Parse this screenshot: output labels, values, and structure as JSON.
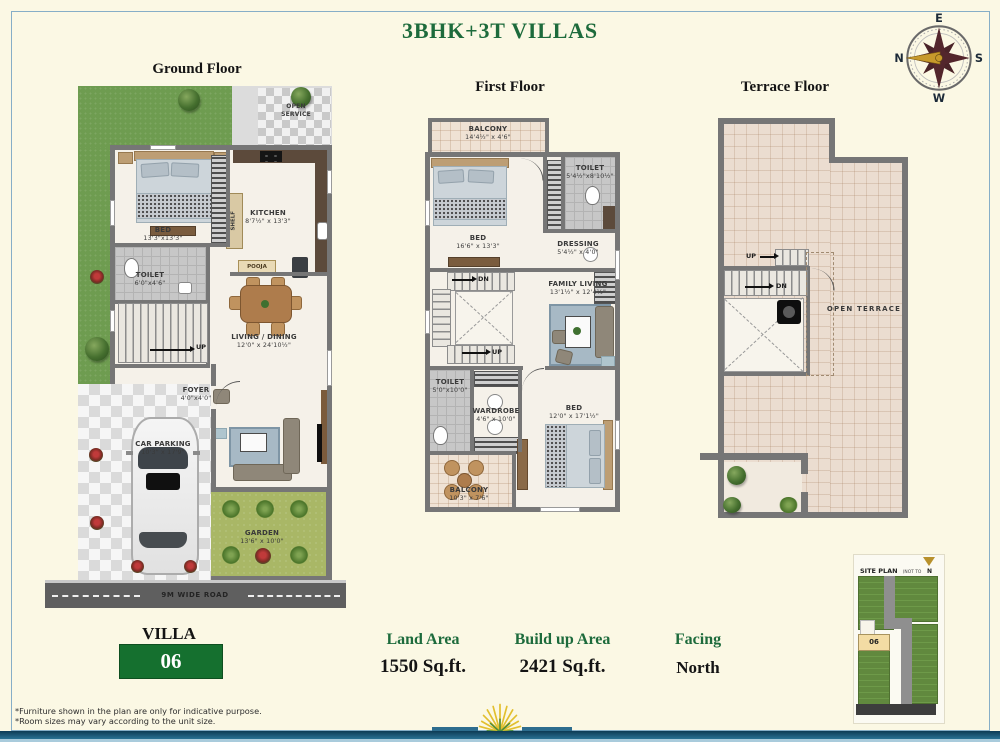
{
  "title": "3BHK+3T VILLAS",
  "compass": {
    "top": "E",
    "right": "S",
    "bottom": "W",
    "left": "N"
  },
  "floors": {
    "ground": {
      "heading": "Ground Floor",
      "open_service": "OPEN SERVICE",
      "bed": {
        "name": "BED",
        "dims": "13'3\"x13'3\""
      },
      "kitchen": {
        "name": "KITCHEN",
        "dims": "8'7½\" x 13'3\""
      },
      "shelf": "SHELF",
      "pooja": "POOJA",
      "toilet": {
        "name": "TOILET",
        "dims": "6'0\"x4'6\""
      },
      "living_dining": {
        "name": "LIVING / DINING",
        "dims": "12'0\" x 24'10½\""
      },
      "up": "UP",
      "md": "MD",
      "foyer": {
        "name": "FOYER",
        "dims": "4'0\"x4'0\""
      },
      "car_parking": {
        "name": "CAR PARKING",
        "dims": "10'3\" x 17'9\""
      },
      "garden": {
        "name": "GARDEN",
        "dims": "13'6\" x 10'0\""
      },
      "road": "9M WIDE ROAD"
    },
    "first": {
      "heading": "First Floor",
      "balcony_top": {
        "name": "BALCONY",
        "dims": "14'4½\" x 4'6\""
      },
      "bed1": {
        "name": "BED",
        "dims": "16'6\" x 13'3\""
      },
      "toilet1": {
        "name": "TOILET",
        "dims": "5'4½\"x8'10½\""
      },
      "dressing": {
        "name": "DRESSING",
        "dims": "5'4½\" x 4'0\""
      },
      "dn": "DN",
      "up": "UP",
      "family_living": {
        "name": "FAMILY LIVING",
        "dims": "13'1½\" x 12'4½\""
      },
      "toilet2": {
        "name": "TOILET",
        "dims": "5'0\"x10'0\""
      },
      "wardrobe": {
        "name": "WARDROBE",
        "dims": "4'6\" x 10'0\""
      },
      "bed2": {
        "name": "BED",
        "dims": "12'0\" x 17'1½\""
      },
      "balcony_bottom": {
        "name": "BALCONY",
        "dims": "10'3\" x 7'6\""
      }
    },
    "terrace": {
      "heading": "Terrace Floor",
      "up": "UP",
      "dn": "DN",
      "open_terrace": "OPEN TERRACE"
    }
  },
  "details": {
    "villa_label": "VILLA",
    "villa_number": "06",
    "land_area": {
      "label": "Land Area",
      "value": "1550 Sq.ft."
    },
    "build_area": {
      "label": "Build up Area",
      "value": "2421 Sq.ft."
    },
    "facing": {
      "label": "Facing",
      "value": "North"
    }
  },
  "site_plan": {
    "title": "SITE PLAN",
    "scale_note": "(NOT TO SCALE)",
    "north": "N",
    "highlighted_plot": "06"
  },
  "footnotes": [
    "*Furniture shown in the plan are only for indicative purpose.",
    "*Room sizes may vary according to the unit size."
  ],
  "colors": {
    "accent_green": "#1D6B3C",
    "villa_box_green": "#15702F",
    "lawn_green": "#6E9C50",
    "wall_gray": "#767676",
    "terrace_tile": "#EBDDD0",
    "road_gray": "#5F5F5F"
  }
}
